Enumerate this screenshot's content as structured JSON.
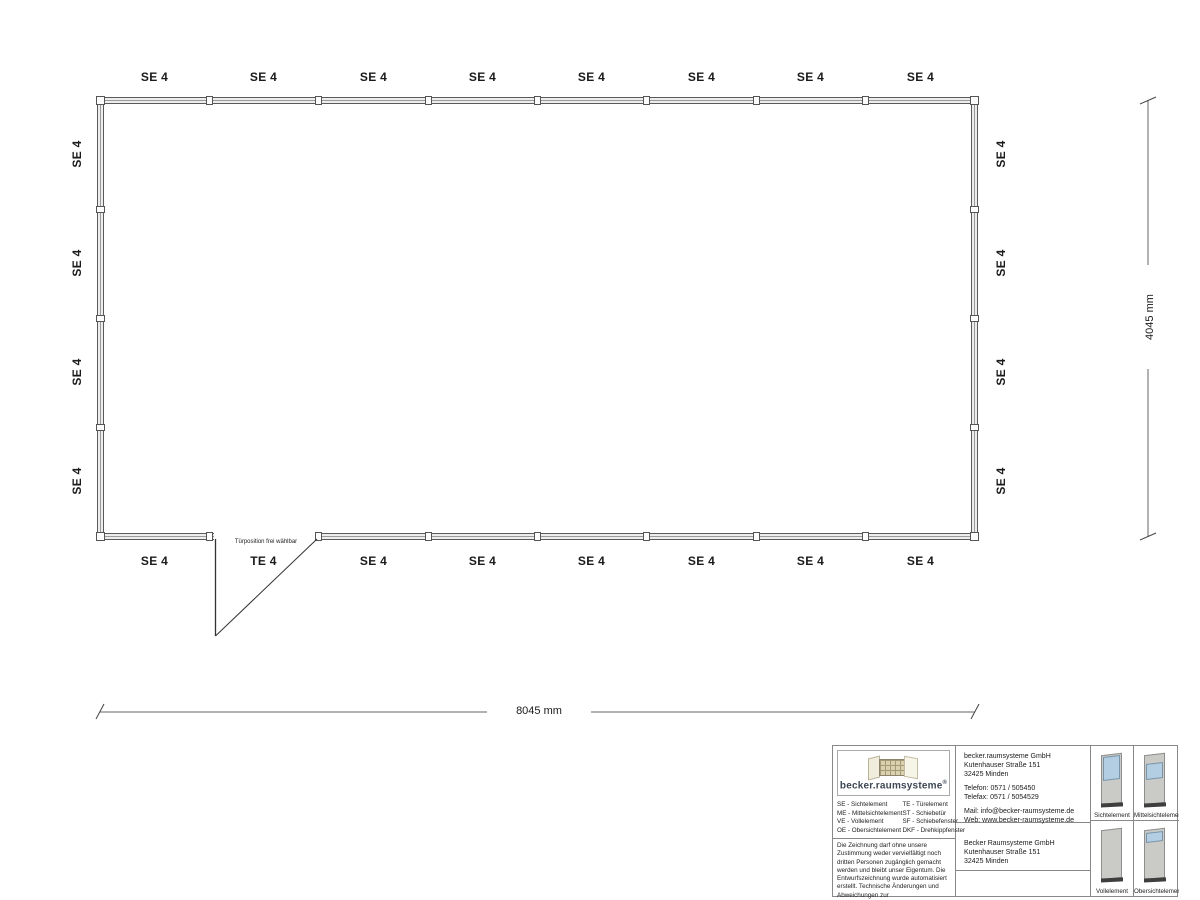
{
  "plan": {
    "top_labels": [
      "SE 4",
      "SE 4",
      "SE 4",
      "SE 4",
      "SE 4",
      "SE 4",
      "SE 4",
      "SE 4"
    ],
    "bottom_labels": [
      "SE 4",
      "TE 4",
      "SE 4",
      "SE 4",
      "SE 4",
      "SE 4",
      "SE 4",
      "SE 4"
    ],
    "left_labels": [
      "SE 4",
      "SE 4",
      "SE 4",
      "SE 4"
    ],
    "right_labels": [
      "SE 4",
      "SE 4",
      "SE 4",
      "SE 4"
    ],
    "door_note": "Türposition frei wählbar",
    "width_dimension": "8045 mm",
    "height_dimension": "4045 mm"
  },
  "title_block": {
    "logo": {
      "text": "becker.raumsysteme",
      "registered": "®"
    },
    "legend": {
      "col1": [
        "SE - Sichtelement",
        "ME - Mittelsichtelement",
        "VE - Vollelement",
        "OE - Obersichtelement"
      ],
      "col2": [
        "TE - Türelement",
        "ST - Schiebetür",
        "SF - Schiebefenster",
        "DKF - Drehkippfenster"
      ]
    },
    "disclaimer": "Die Zeichnung darf ohne unsere Zustimmung weder vervielfältigt noch dritten Personen zugänglich gemacht werden und bleibt unser Eigentum. Die Entwurfszeichnung wurde automatisiert erstellt. Technische Änderungen und Abweichungen zur Ausführungszeichnung behalten wir uns vor.",
    "manufacturer": {
      "name": "becker.raumsysteme GmbH",
      "street": "Kutenhauser Straße 151",
      "city": "32425 Minden",
      "phone": "Telefon: 0571 / 505450",
      "fax": "Telefax: 0571 / 5054529",
      "mail": "Mail: info@becker-raumsysteme.de",
      "web": "Web: www.becker-raumsysteme.de"
    },
    "customer": {
      "name": "Becker Raumsysteme GmbH",
      "street": "Kutenhauser Straße 151",
      "city": "32425 Minden"
    },
    "element_previews": [
      {
        "label": "Sichtelement"
      },
      {
        "label": "Mittelsichtelement"
      },
      {
        "label": "Vollelement"
      },
      {
        "label": "Obersichtelement"
      }
    ]
  },
  "colors": {
    "wall_line": "#555555",
    "glass": "#b3cde2",
    "panel_body": "#cacac6",
    "panel_base": "#3f3f3f",
    "logo_text": "#3d4654"
  }
}
